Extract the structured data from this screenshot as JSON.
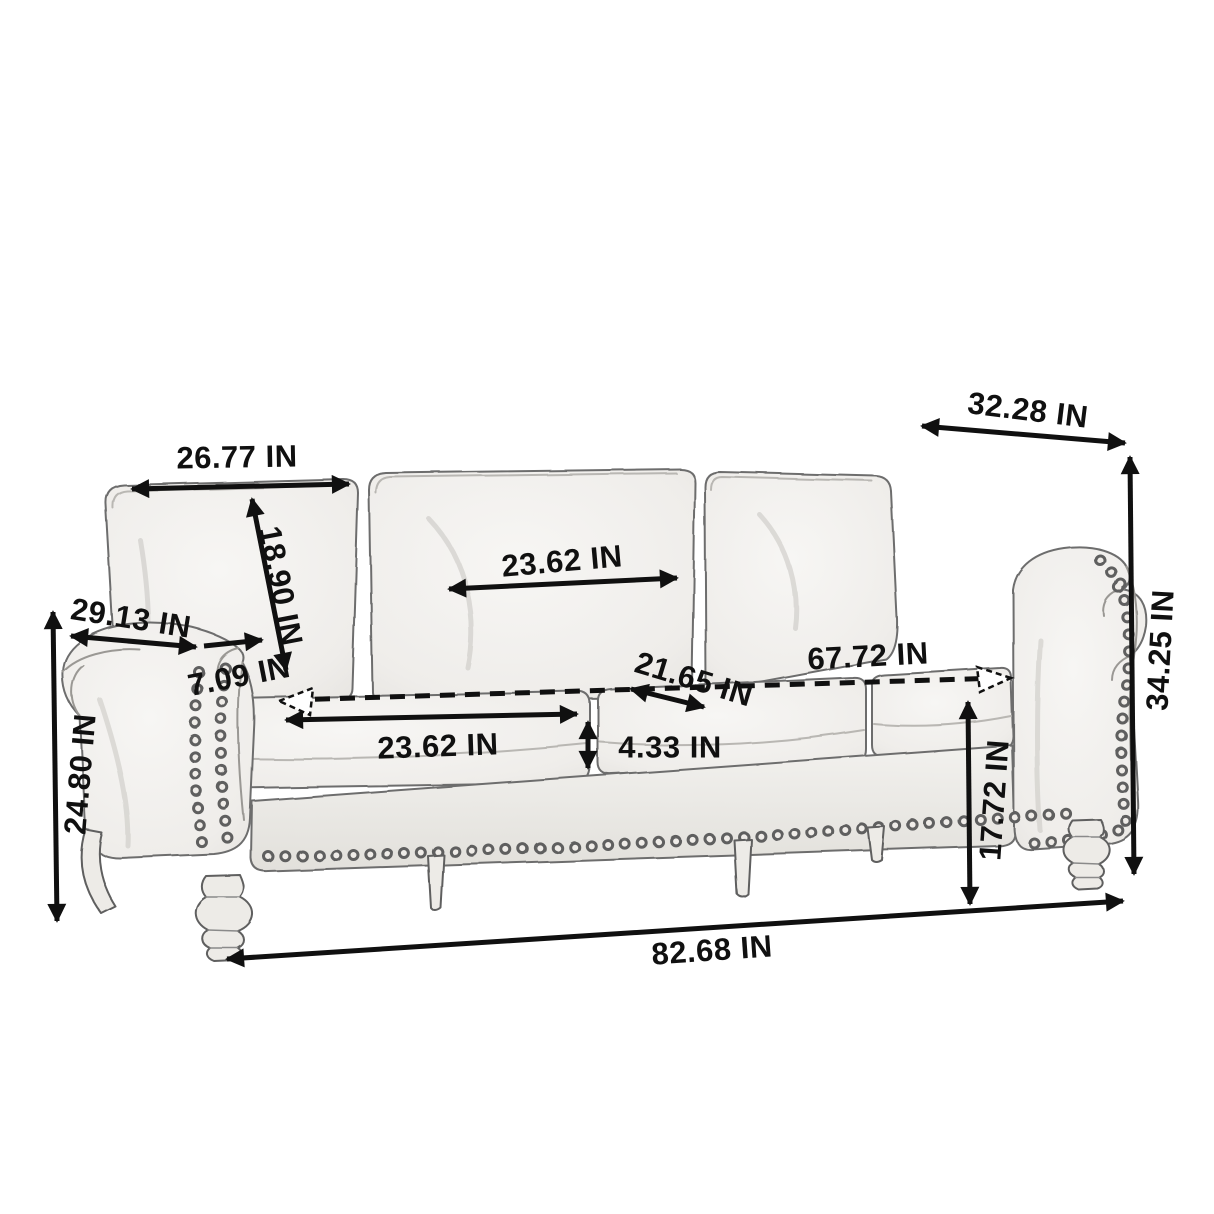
{
  "diagram": {
    "subject": "sofa-dimension-drawing",
    "unit": "IN",
    "labels": {
      "back_cushion_width": "26.77 IN",
      "back_cushion_height": "18.90 IN",
      "arm_length": "29.13 IN",
      "arm_thickness": "7.09 IN",
      "mid_back_cushion_width": "23.62 IN",
      "seat_cushion_width": "23.62 IN",
      "seat_depth": "21.65 IN",
      "inner_seat_width": "67.72 IN",
      "seat_cushion_thickness": "4.33 IN",
      "seat_height": "17.72 IN",
      "overall_height": "34.25 IN",
      "overall_depth": "32.28 IN",
      "arm_height": "24.80 IN",
      "overall_width": "82.68 IN"
    }
  }
}
